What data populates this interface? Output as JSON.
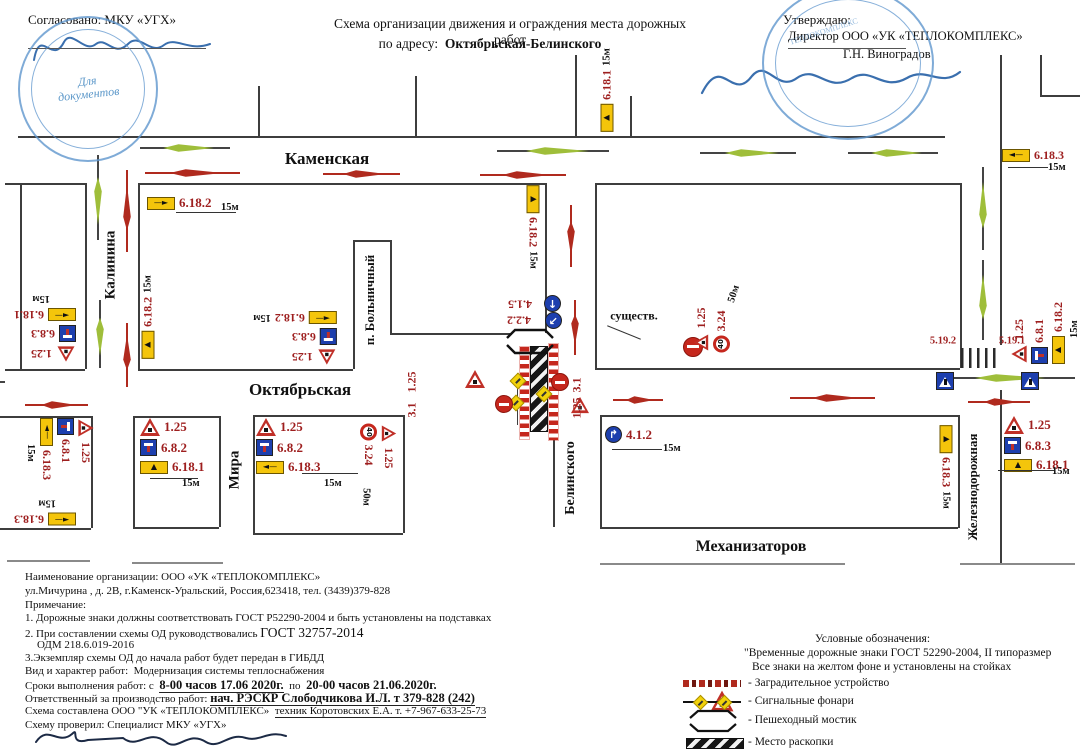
{
  "header": {
    "agreed": "Согласовано: МКУ «УГХ»",
    "stamp_left_line1": "Для",
    "stamp_left_line2": "документов",
    "stamp_right_ring": "ТЕПЛОКОМПЛЕКС",
    "title_line1": "Схема организации движения и ограждения места дорожных работ",
    "title_line2_prefix": "по адресу:",
    "title_line2_address": "Октябрьская-Белинского",
    "approve": "Утверждаю:",
    "approve_org": "Директор ООО «УК «ТЕПЛОКОМПЛЕКС»",
    "approve_name": "Г.Н. Виноградов"
  },
  "streets": {
    "kamenskaya": "Каменская",
    "kalinina": "Калинина",
    "bolnichny": "п. Больничный",
    "oktyabrskaya": "Октябрьская",
    "mira": "Мира",
    "belinskogo": "Белинского",
    "mekhanizatorov": "Механизаторов",
    "zheleznodorozhnaya": "Железнодорожная"
  },
  "map_labels": {
    "existing": "существ."
  },
  "signs": {
    "g1": {
      "labels": [
        "6.18.1"
      ],
      "dist": "15м"
    },
    "g2": {
      "labels": [
        "6.18.3"
      ],
      "dist": "15м"
    },
    "g3": {
      "labels": [
        "6.18.2"
      ],
      "dist": "15м"
    },
    "g4": {
      "labels": [
        "6.18.2"
      ],
      "dist": "15м"
    },
    "g5": {
      "labels": [
        "1.25",
        "6.8.3",
        "6.18.2"
      ],
      "dist": "15м"
    },
    "g6": {
      "labels": [
        "1.25",
        "6.8.3",
        "6.18.1"
      ],
      "dist": "15м"
    },
    "g7": {
      "labels": [
        "1.25",
        "6.8.1",
        "6.18.3"
      ],
      "dist": "15м"
    },
    "g8": {
      "labels": [
        "6.18.3"
      ],
      "dist": "15м"
    },
    "g9": {
      "labels": [
        "6.18.2"
      ],
      "dist": "15м"
    },
    "g10": {
      "labels": [
        "4.1.5",
        "4.2.2"
      ]
    },
    "g12": {
      "labels": [
        "1.25",
        "3.24"
      ],
      "dist": "50м"
    },
    "g13": {
      "labels": [
        "3.1",
        "1.25"
      ]
    },
    "g14": {
      "labels": [
        "1.25",
        "3.1"
      ]
    },
    "g15": {
      "labels": [
        "1.25",
        "3.24"
      ],
      "dist": "50м"
    },
    "g16": {
      "labels": [
        "1.25",
        "6.8.2",
        "6.18.1"
      ],
      "dist": "15м"
    },
    "g17": {
      "labels": [
        "1.25",
        "6.8.2",
        "6.18.3"
      ],
      "dist": "15м"
    },
    "g18": {
      "labels": [
        "4.1.2"
      ],
      "dist": "15м"
    },
    "g19": {
      "labels": [
        "5.19.2"
      ]
    },
    "g20": {
      "labels": [
        "5.19.1"
      ]
    },
    "g21": {
      "labels": [
        "1.25",
        "6.8.1",
        "6.18.2"
      ],
      "dist": "15м"
    },
    "g23": {
      "labels": [
        "1.25",
        "6.8.3",
        "6.18.1"
      ],
      "dist": "15м"
    },
    "g24": {
      "labels": [
        "6.18.3"
      ],
      "dist": "15м"
    }
  },
  "notes": {
    "org": "Наименование организации: ООО «УК «ТЕПЛОКОМПЛЕКС»",
    "address": "ул.Мичурина , д. 2В, г.Каменск-Уральский, Россия,623418,  тел. (3439)379-828",
    "note_title": "Примечание:",
    "note1": "1. Дорожные знаки должны соответствовать ГОСТ Р52290-2004 и быть установлены на подставках",
    "note2_prefix": "2. При составлении схемы ОД руководствовались",
    "note2_gost": "ГОСТ 32757-2014",
    "note2b": "ОДМ 218.6.019-2016",
    "note3": "3.Экземпляр схемы ОД до начала работ будет передан в ГИБДД",
    "work_type_label": "Вид и характер работ:",
    "work_type": "Модернизация системы теплоснабжения",
    "terms_prefix": "Сроки выполнения работ: с",
    "terms_bold1": "8-00 часов 17.06 2020г.",
    "terms_mid": "по",
    "terms_bold2": "20-00 часов 21.06.2020г.",
    "resp_prefix": "Ответственный за производство работ:",
    "resp_bold": "нач. РЭСКР Слободчикова И.Л. т 379-828 (242)",
    "made_prefix": "Схема составлена ООО \"УК «ТЕПЛОКОМПЛЕКС»",
    "made_person": "техник Коротовских Е.А. т. +7-967-633-25-73",
    "checked": "Схему проверил: Специалист МКУ «УГХ»"
  },
  "legend": {
    "title": "Условные обозначения:",
    "item1_line1": "\"Временные дорожные знаки ГОСТ 52290-2004, II типоразмер",
    "item1_line2": "Все знаки на желтом фоне и установлены на стойках",
    "item2": "- Заградительное устройство",
    "item3": "- Сигнальные фонари",
    "item4": "- Пешеходный мостик",
    "item5": "- Место раскопки"
  },
  "colors": {
    "label_red": "#9e1f1f",
    "arrow_green": "#9fbe3a",
    "arrow_red": "#b02a1e",
    "sign_yellow": "#f4c50b",
    "sign_blue": "#1d3fae",
    "stamp_blue": "#5f96cd"
  }
}
